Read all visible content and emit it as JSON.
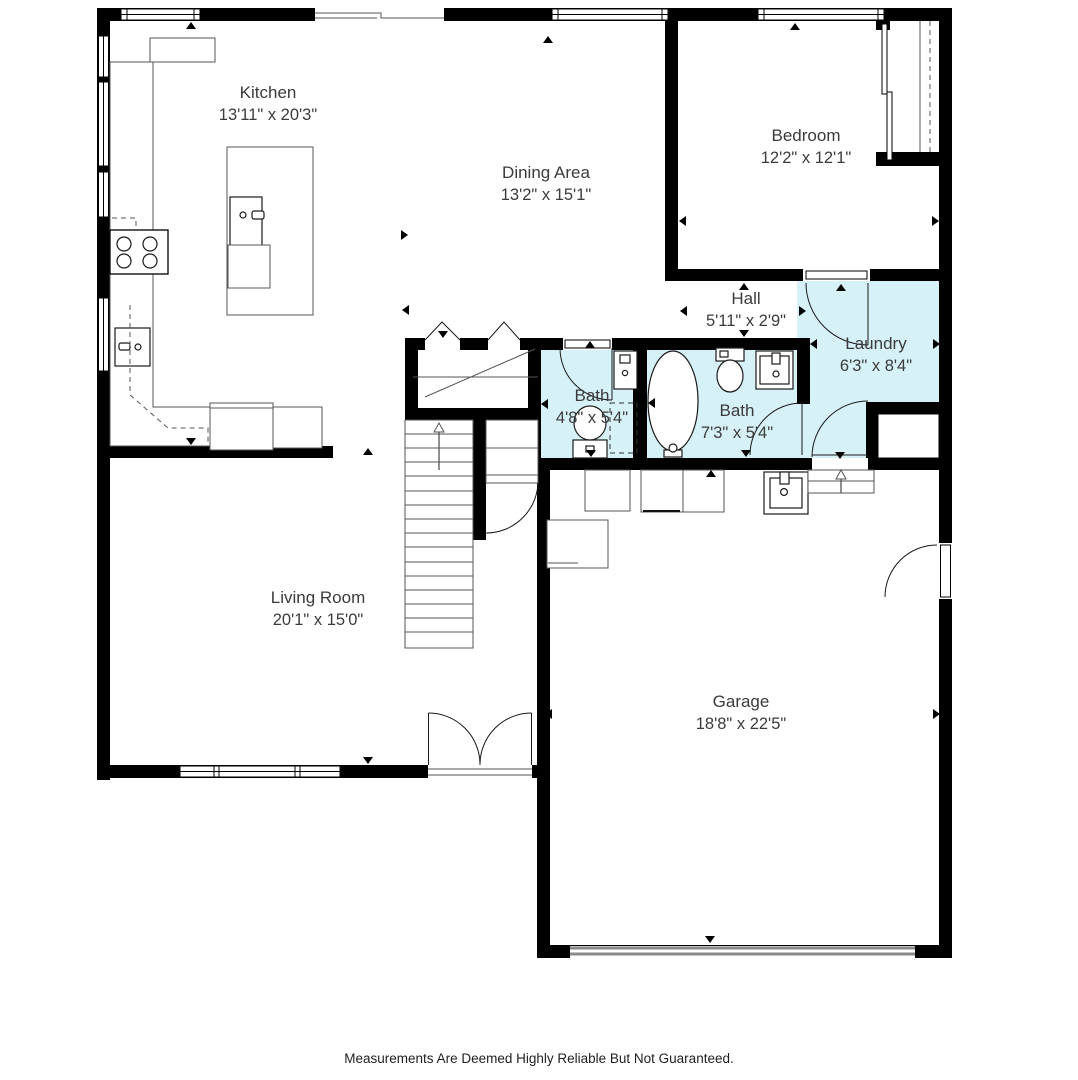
{
  "rooms": [
    {
      "name": "Kitchen",
      "dims": "13'11\" x 20'3\""
    },
    {
      "name": "Dining Area",
      "dims": "13'2\" x 15'1\""
    },
    {
      "name": "Bedroom",
      "dims": "12'2\" x 12'1\""
    },
    {
      "name": "Hall",
      "dims": "5'11\" x 2'9\""
    },
    {
      "name": "Laundry",
      "dims": "6'3\" x 8'4\""
    },
    {
      "name": "Bath",
      "dims": "4'8\" x 5'4\""
    },
    {
      "name": "Bath",
      "dims": "7'3\" x 5'4\""
    },
    {
      "name": "Living Room",
      "dims": "20'1\" x 15'0\""
    },
    {
      "name": "Garage",
      "dims": "18'8\" x 22'5\""
    }
  ],
  "disclaimer": "Measurements Are Deemed Highly Reliable But Not Guaranteed.",
  "colors": {
    "wet_area_fill": "#d7f1f8",
    "wall": "#000000",
    "background": "#ffffff",
    "label_text": "#3b3b3b"
  }
}
